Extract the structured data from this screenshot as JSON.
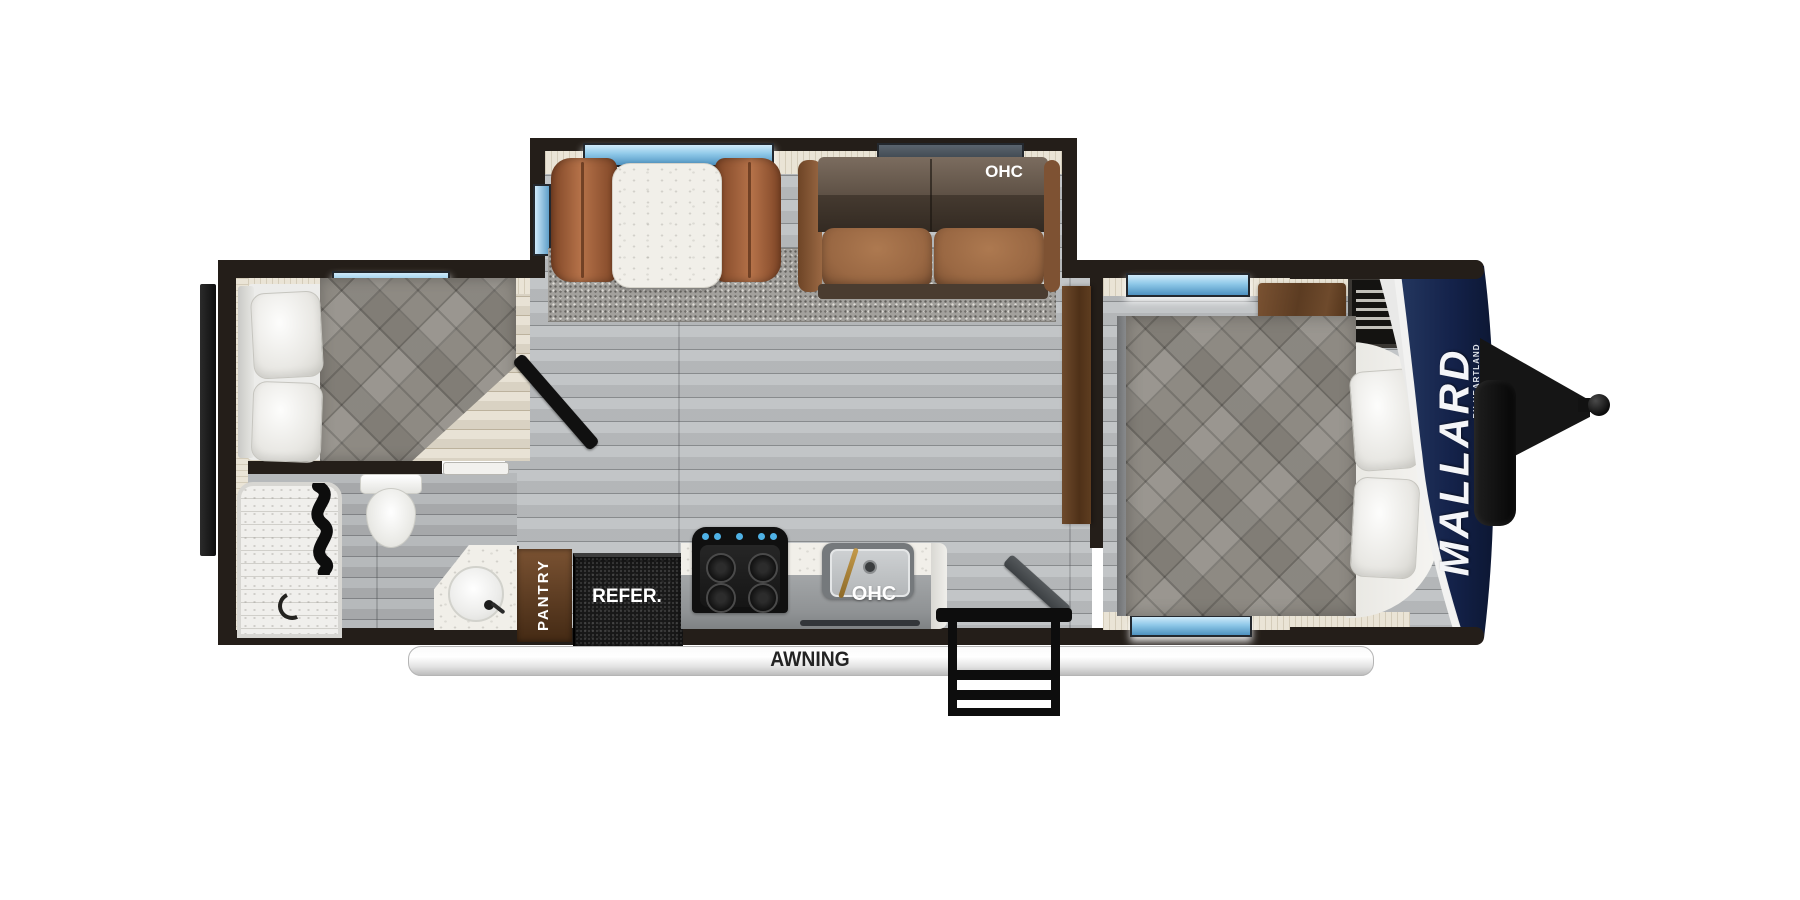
{
  "brand": {
    "name": "MALLARD",
    "byline": "BY HEARTLAND"
  },
  "labels": {
    "sofa_overhead_cabinet": "OHC",
    "kitchen_overhead_cabinet": "OHC",
    "pantry": "PANTRY",
    "refrigerator": "REFER.",
    "awning": "AWNING"
  },
  "colors": {
    "wall_dark": "#241e19",
    "floor_gray": "#bdc0c2",
    "interior_lining": "#eae4d6",
    "sofa_brown": "#9a6843",
    "dinette_brown": "#a8663f",
    "wood_brown": "#6e4a2e",
    "comforter_gray": "#8e8a83",
    "window_blue": "#8ec8e8",
    "front_cap_navy": "#16244a",
    "awning_white": "#f5f5f5"
  }
}
